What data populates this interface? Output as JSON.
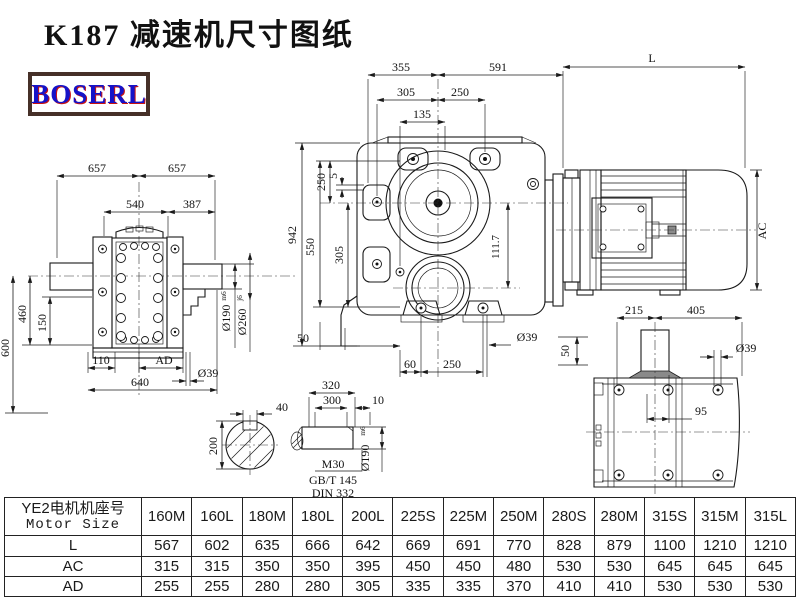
{
  "title": "K187 减速机尺寸图纸",
  "logo_text": "BOSERL",
  "views": {
    "front": {
      "d657a": "657",
      "d657b": "657",
      "d540": "540",
      "d387": "387",
      "d600": "600",
      "d460": "460",
      "d150": "150",
      "d110": "110",
      "dAD": "AD",
      "d640": "640",
      "d39": "Ø39",
      "d190": "Ø190",
      "d190tol": "m6",
      "d260": "Ø260",
      "d260tol": "j6"
    },
    "side": {
      "d355": "355",
      "d591": "591",
      "d305t": "305",
      "d250t": "250",
      "d135": "135",
      "d5": "5",
      "d250l": "250",
      "d550": "550",
      "d305l": "305",
      "d942": "942",
      "d1117": "111.7",
      "d50l": "50",
      "d60": "60",
      "d250b": "250",
      "d39": "Ø39",
      "d50r": "50"
    },
    "motor": {
      "dL": "L",
      "dAC": "AC"
    },
    "top": {
      "d215": "215",
      "d405": "405",
      "d95": "95",
      "d39": "Ø39"
    },
    "shaft": {
      "d320": "320",
      "d300": "300",
      "d10": "10",
      "d190": "Ø190",
      "d190tol": "m6",
      "m30": "M30",
      "gbt": "GB/T 145",
      "din": "DIN 332"
    },
    "section": {
      "d40": "40",
      "d200": "200"
    }
  },
  "table": {
    "header_cn": "YE2电机机座号",
    "header_en": "Motor Size",
    "columns": [
      "160M",
      "160L",
      "180M",
      "180L",
      "200L",
      "225S",
      "225M",
      "250M",
      "280S",
      "280M",
      "315S",
      "315M",
      "315L"
    ],
    "rows": [
      {
        "label": "L",
        "values": [
          "567",
          "602",
          "635",
          "666",
          "642",
          "669",
          "691",
          "770",
          "828",
          "879",
          "1100",
          "1210",
          "1210"
        ]
      },
      {
        "label": "AC",
        "values": [
          "315",
          "315",
          "350",
          "350",
          "395",
          "450",
          "450",
          "480",
          "530",
          "530",
          "645",
          "645",
          "645"
        ]
      },
      {
        "label": "AD",
        "values": [
          "255",
          "255",
          "280",
          "280",
          "305",
          "335",
          "335",
          "370",
          "410",
          "410",
          "530",
          "530",
          "530"
        ]
      }
    ]
  }
}
